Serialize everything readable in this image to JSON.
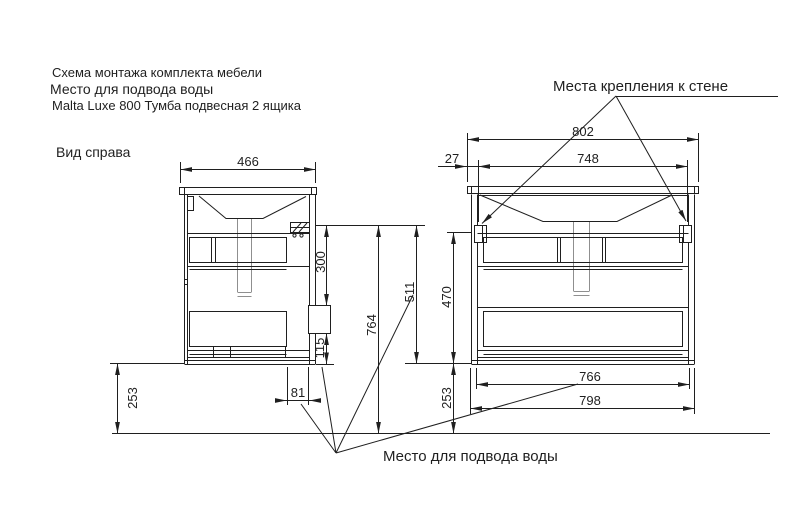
{
  "header": {
    "line1": "Схема монтажа комплекта мебели",
    "line2": "Место для подвода воды",
    "line3": "Malta Luxe  800 Тумба подвесная 2 ящика"
  },
  "labels": {
    "side_view": "Вид справа",
    "wall_mounts": "Места крепления к стене",
    "water_supply": "Место для подвода воды"
  },
  "side_view_dims": {
    "depth": "466",
    "bracket_to_water_box": "300",
    "water_box_to_bottom": "115",
    "floor_to_bracket": "764",
    "water_offset": "81",
    "floor_to_bottom": "253"
  },
  "front_view_dims": {
    "overall_width": "802",
    "edge_to_bracket": "27",
    "bracket_span": "748",
    "bracket_to_bottom": "511",
    "body_height": "470",
    "inner_width": "766",
    "body_width": "798",
    "floor_to_bottom": "253"
  }
}
